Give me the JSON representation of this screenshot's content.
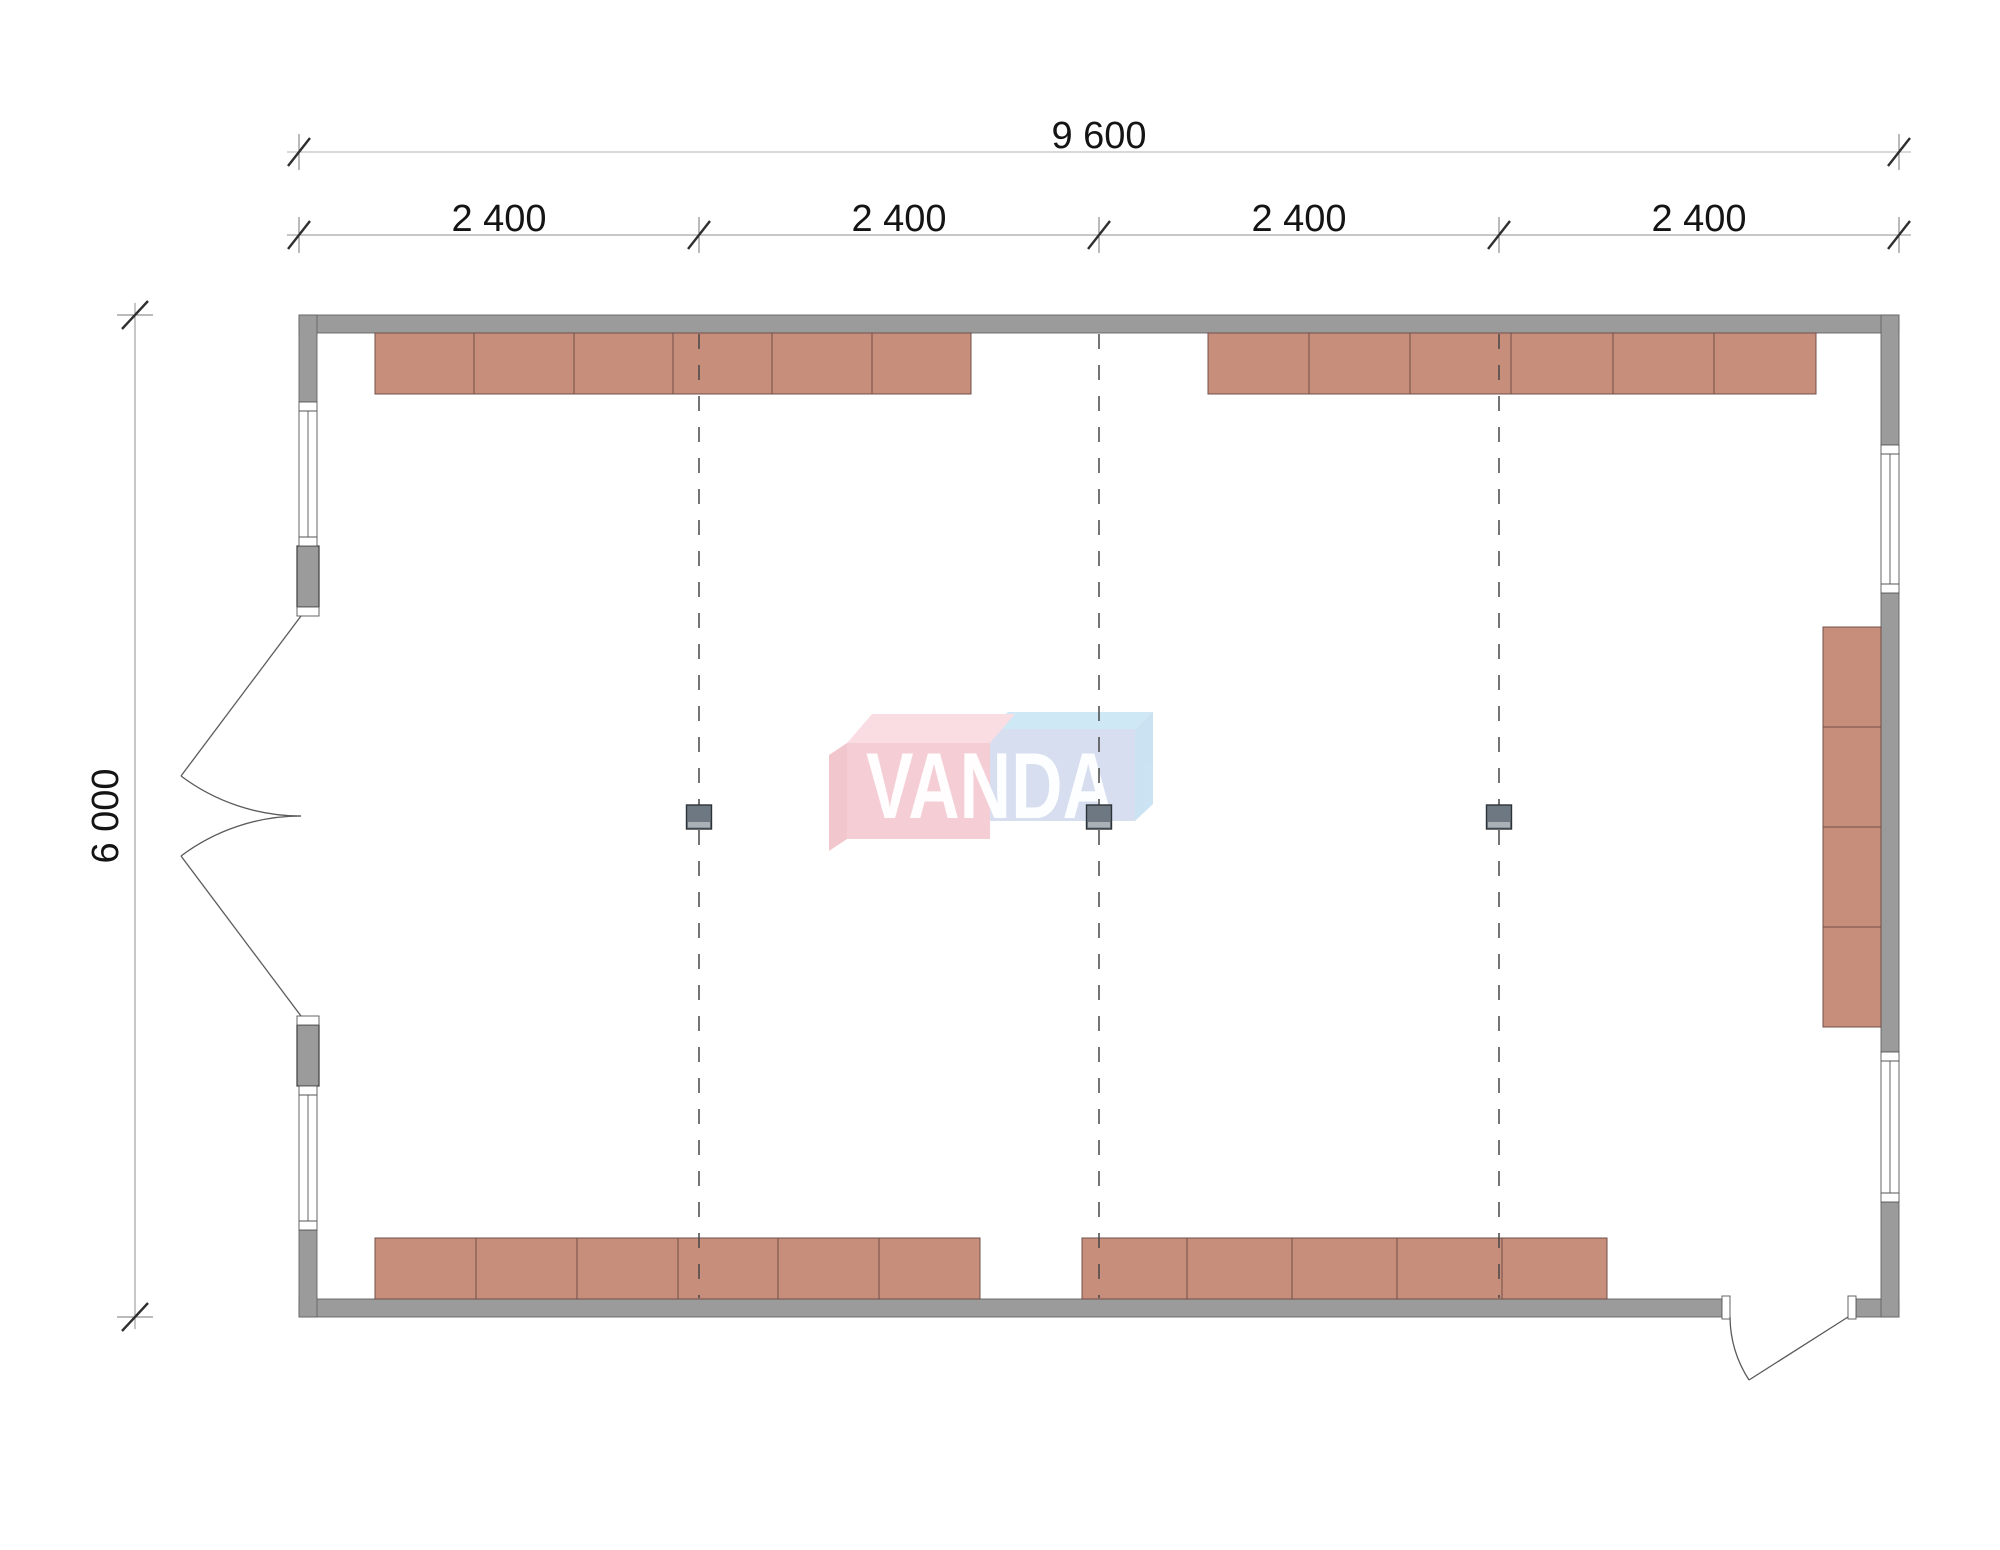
{
  "drawing": {
    "type": "architectural-floor-plan",
    "dimensions": {
      "overall_width_label": "9 600",
      "segment_labels": [
        "2 400",
        "2 400",
        "2 400",
        "2 400"
      ],
      "overall_height_label": "6 000"
    },
    "watermark": {
      "text": "VANDA"
    },
    "furniture": {
      "top_left_run_units": 6,
      "top_right_run_units": 6,
      "bottom_left_run_units": 6,
      "bottom_right_run_units": 5,
      "right_wall_run_units": 4,
      "columns": 3
    },
    "colors": {
      "wall_fill": "#9b9b9b",
      "cabinet_fill": "#c88e7c",
      "cabinet_outline": "#6f5047",
      "column_fill": "#6d7883",
      "grid_line": "#474747",
      "wall_inner_strip": "#b6bec4",
      "logo_red_front": "#f5ccd3",
      "logo_red_top": "#f9dce2",
      "logo_red_side": "#f2c3cb",
      "logo_blue_front": "#d4ddef",
      "logo_blue_top": "#cde7f6",
      "logo_blue_side": "#c8e1f2"
    }
  }
}
